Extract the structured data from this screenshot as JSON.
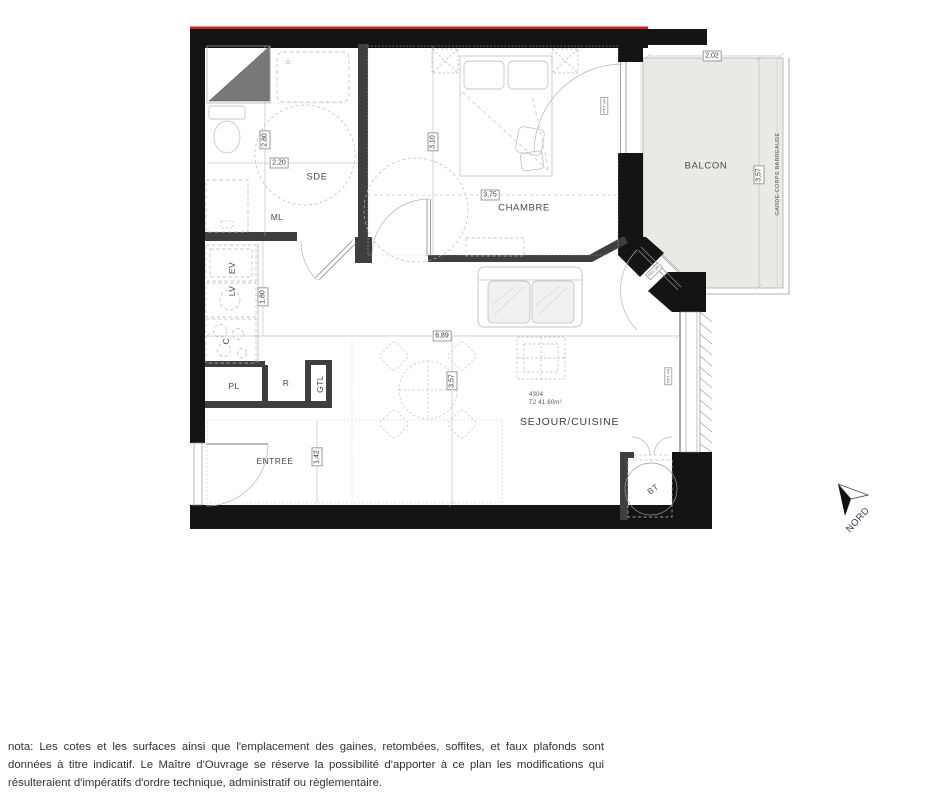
{
  "title_block": {
    "unit_number": "4304",
    "unit_area": "T2 41.60m²"
  },
  "rooms": {
    "sde": "SDE",
    "chambre": "CHAMBRE",
    "balcon": "BALCON",
    "sejour_cuisine": "SEJOUR/CUISINE",
    "entree": "ENTREE"
  },
  "equipment": {
    "ml": "ML",
    "ev": "EV",
    "lv": "LV",
    "c": "C",
    "pl": "PL",
    "r": "R",
    "gtl": "GTL",
    "bt": "BT"
  },
  "dimensions": {
    "sde_height": "2,80",
    "sde_width": "2,20",
    "chambre_height": "3,10",
    "chambre_width": "3,75",
    "kitchen_height": "1,80",
    "sejour_width": "6,89",
    "sejour_height": "3,57",
    "entree_height": "1,42",
    "balcon_width": "2,02",
    "balcon_height": "3,57"
  },
  "annotations": {
    "railing": "GARDE-CORPS BARREAUDE",
    "north": "NORD",
    "window_tag_chambre": "PF1 VR",
    "window_tag_balcony_door": "PF1 VR",
    "window_tag_sejour_window": "OF1 VR"
  },
  "nota": {
    "line1": "nota: Les cotes et les surfaces ainsi que l'emplacement des gaines, retombées, soffites, et faux plafonds sont",
    "line2": "données à titre indicatif. Le Maître d'Ouvrage se réserve la possibilité d'apporter à ce plan les modifications qui",
    "line3": "résulteraient d'impératifs d'ordre technique, administratif ou règlementaire."
  },
  "colors": {
    "wall": "#141414",
    "interior_wall": "#3f3f3f",
    "accent_red": "#d01f26",
    "balcony_fill": "#e9e9e6",
    "line": "#9a9a9a",
    "text": "#4a4a4a"
  }
}
